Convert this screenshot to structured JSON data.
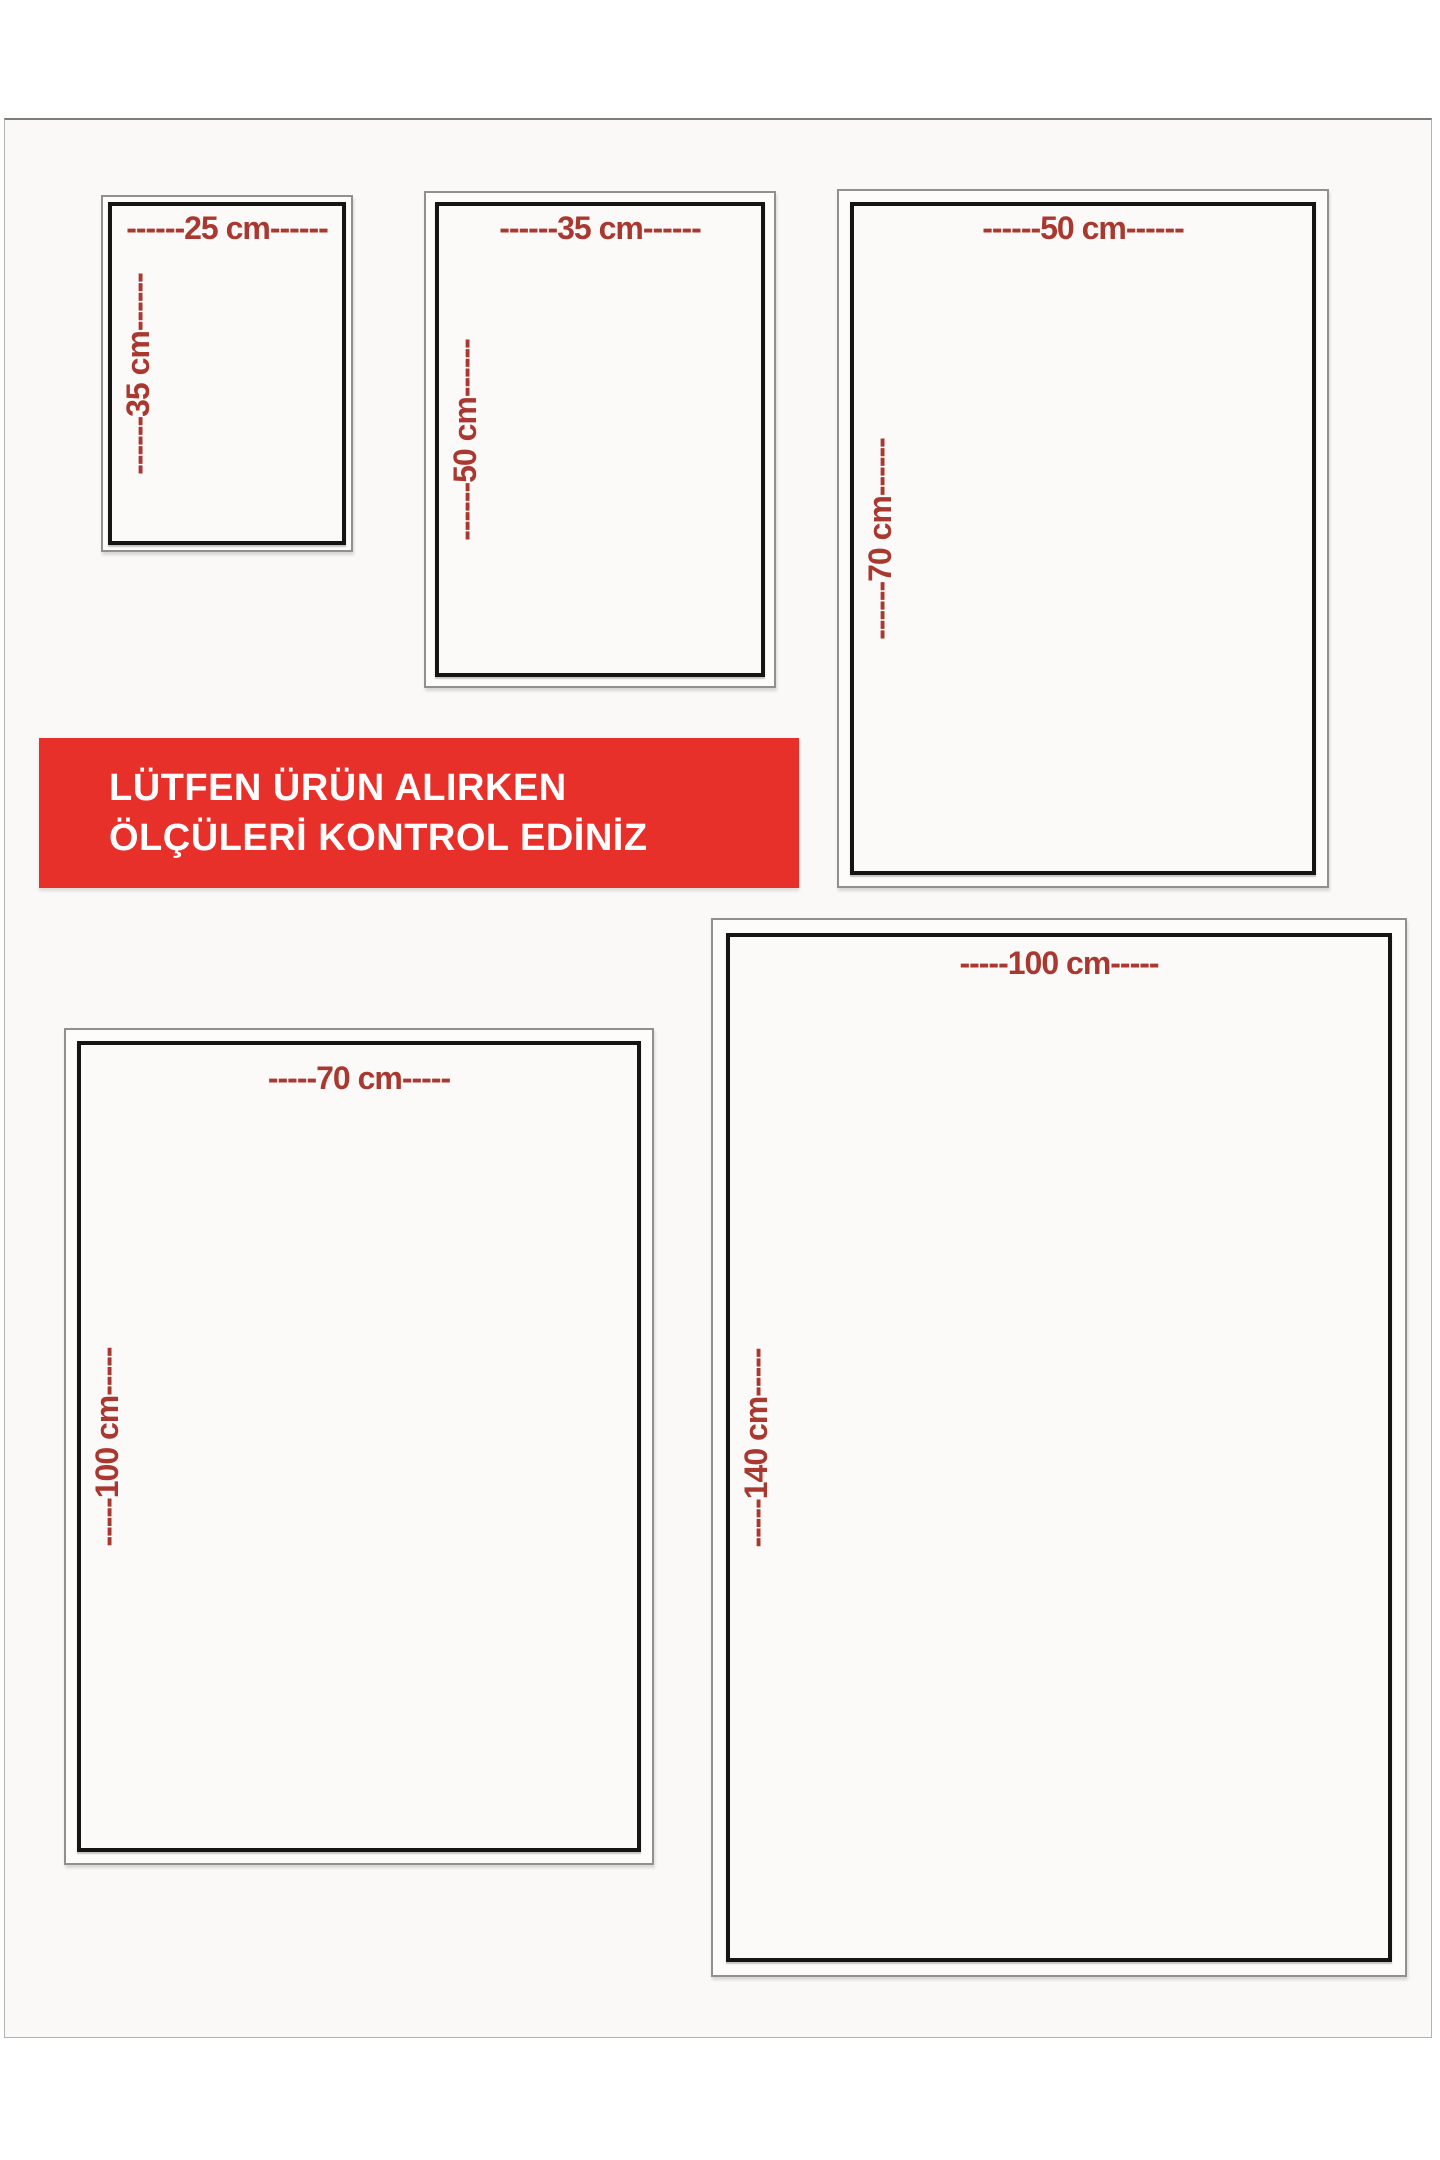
{
  "page": {
    "background_color": "#ffffff",
    "card_background_color": "#faf9f7",
    "frame_border_color": "#b3b3b1"
  },
  "notice_banner": {
    "line1": "LÜTFEN ÜRÜN ALIRKEN",
    "line2": "ÖLÇÜLERİ KONTROL EDİNİZ",
    "background_color": "#e7302a",
    "text_color": "#ffffff"
  },
  "dimension_label_color": "#a93830",
  "box_border_colors": {
    "outer": "#90908d",
    "inner": "#161512"
  },
  "boxes": [
    {
      "name": "25x35",
      "width_cm": 25,
      "height_cm": 35,
      "width_label": "------25 cm------",
      "height_label": "------35 cm------"
    },
    {
      "name": "35x50",
      "width_cm": 35,
      "height_cm": 50,
      "width_label": "------35 cm------",
      "height_label": "------50 cm------"
    },
    {
      "name": "50x70",
      "width_cm": 50,
      "height_cm": 70,
      "width_label": "------50 cm------",
      "height_label": "------70 cm------"
    },
    {
      "name": "70x100",
      "width_cm": 70,
      "height_cm": 100,
      "width_label": "-----70 cm-----",
      "height_label": "-----100 cm-----"
    },
    {
      "name": "100x140",
      "width_cm": 100,
      "height_cm": 140,
      "width_label": "-----100 cm-----",
      "height_label": "-----140 cm-----"
    }
  ]
}
